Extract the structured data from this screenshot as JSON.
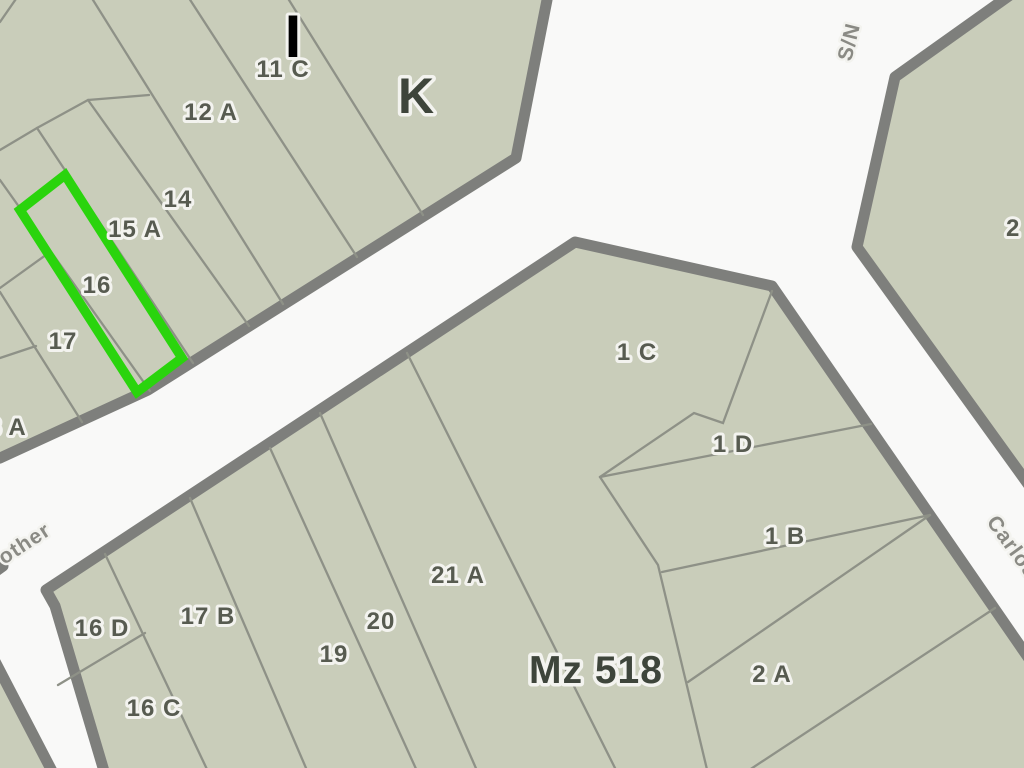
{
  "map": {
    "type": "cadastral-parcel-map",
    "colors": {
      "street": "#f9f9f8",
      "block_fill": "#c9cdba",
      "block_border": "#7e7f7c",
      "parcel_line": "#8e9187",
      "label": "#575b50",
      "label_dark": "#3e453b",
      "street_label": "#8a8a84",
      "block_letter": "#000000",
      "halo": "#f3f3ef",
      "highlight": "#2ad40d"
    },
    "highlighted_parcel": {
      "number": "16",
      "outline_color": "#2ad40d"
    },
    "block_names": {
      "northwest": "I",
      "north": "K",
      "south": "Mz 518"
    },
    "parcel_labels": [
      {
        "id": "block-letter-I",
        "text": "I"
      },
      {
        "id": "parcel-11c",
        "text": "11 C"
      },
      {
        "id": "parcel-12a",
        "text": "12 A"
      },
      {
        "id": "parcel-14",
        "text": "14"
      },
      {
        "id": "parcel-15a",
        "text": "15 A"
      },
      {
        "id": "parcel-16",
        "text": "16"
      },
      {
        "id": "parcel-17",
        "text": "17"
      },
      {
        "id": "parcel-8a-clipped",
        "text": "8 A"
      },
      {
        "id": "block-letter-K",
        "text": "K"
      },
      {
        "id": "parcel-1c",
        "text": "1 C"
      },
      {
        "id": "parcel-1d",
        "text": "1 D"
      },
      {
        "id": "parcel-1b",
        "text": "1 B"
      },
      {
        "id": "parcel-2a",
        "text": "2 A"
      },
      {
        "id": "parcel-21a",
        "text": "21 A"
      },
      {
        "id": "parcel-20",
        "text": "20"
      },
      {
        "id": "parcel-19",
        "text": "19"
      },
      {
        "id": "parcel-17b",
        "text": "17 B"
      },
      {
        "id": "parcel-16d",
        "text": "16 D"
      },
      {
        "id": "parcel-16c",
        "text": "16 C"
      },
      {
        "id": "block-mz518-label",
        "text": "Mz 518"
      },
      {
        "id": "parcel-2a-edge-clipped",
        "text": "2 A"
      }
    ],
    "street_labels": [
      {
        "id": "street-other",
        "text": "other"
      },
      {
        "id": "street-sn",
        "text": "S/N"
      },
      {
        "id": "street-carlos",
        "text": "Carlos"
      }
    ]
  }
}
